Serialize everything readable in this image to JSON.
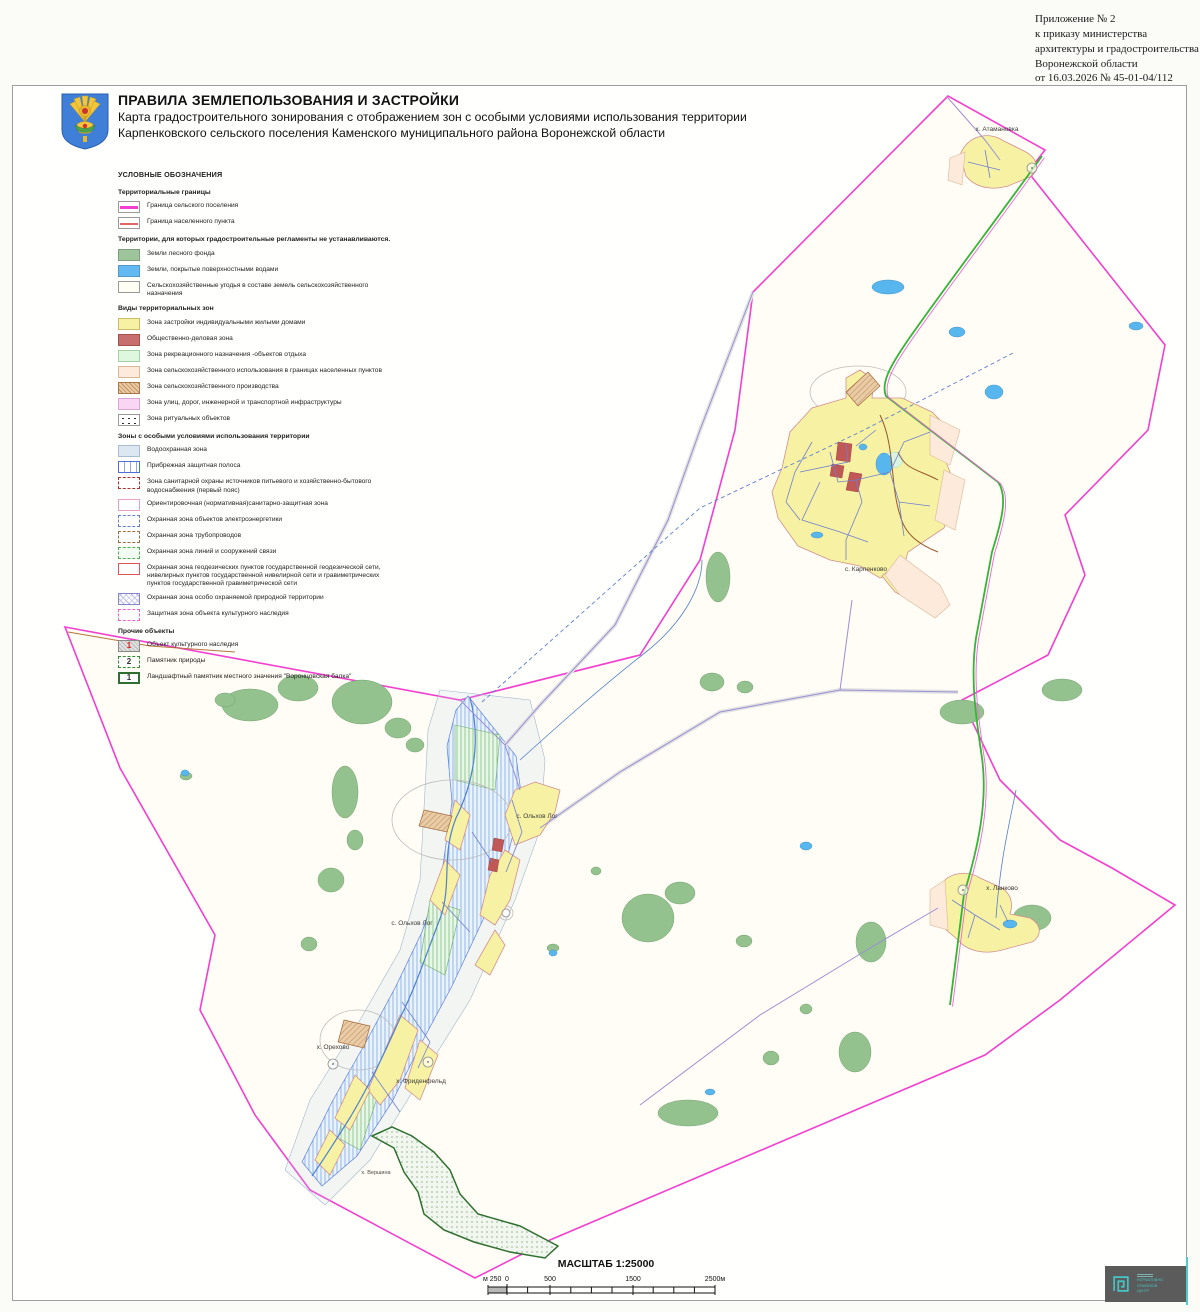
{
  "annotation": {
    "lines": [
      "Приложение № 2",
      "к приказу министерства",
      "архитектуры и градостроительства",
      "Воронежской области",
      "от 16.03.2026 № 45-01-04/112"
    ]
  },
  "header": {
    "title": "ПРАВИЛА ЗЕМЛЕПОЛЬЗОВАНИЯ И ЗАСТРОЙКИ",
    "subtitle_line1": "Карта градостроительного зонирования с отображением зон с особыми условиями использования территории",
    "subtitle_line2": "Карпенковского сельского поселения Каменского муниципального района Воронежской области"
  },
  "legend": {
    "heading": "УСЛОВНЫЕ ОБОЗНАЧЕНИЯ",
    "sections": [
      {
        "title": "Территориальные границы",
        "items": [
          {
            "swatch": "sw-line-magenta",
            "label": "Граница сельского поселения"
          },
          {
            "swatch": "sw-line-red",
            "label": "Граница населенного пункта"
          }
        ]
      },
      {
        "title": "Территории, для которых градостроительные регламенты не устанавливаются.",
        "items": [
          {
            "swatch": "sw-forest",
            "label": "Земли лесного фонда"
          },
          {
            "swatch": "sw-water",
            "label": "Земли, покрытые поверхностными водами"
          },
          {
            "swatch": "sw-agro",
            "label": "Сельскохозяйственные угодья в составе земель сельскохозяйственного назначения"
          }
        ]
      },
      {
        "title": "Виды территориальных зон",
        "items": [
          {
            "swatch": "sw-res",
            "label": "Зона застройки индивидуальными жилыми домами"
          },
          {
            "swatch": "sw-biz",
            "label": "Общественно-деловая зона"
          },
          {
            "swatch": "sw-rec",
            "label": "Зона рекреационного назначения -объектов отдыха"
          },
          {
            "swatch": "sw-agro-set",
            "label": "Зона сельскохозяйственного использования в границах населенных пунктов"
          },
          {
            "swatch": "sw-agro-prod",
            "label": "Зона сельскохозяйственного производства"
          },
          {
            "swatch": "sw-transport",
            "label": "Зона улиц, дорог, инженерной и транспортной инфраструктуры"
          },
          {
            "swatch": "sw-ritual",
            "label": "Зона ритуальных объектов"
          }
        ]
      },
      {
        "title": "Зоны с особыми условиями использования территории",
        "items": [
          {
            "swatch": "sw-wpz",
            "label": "Водоохранная зона"
          },
          {
            "swatch": "sw-shore",
            "label": "Прибрежная защитная полоса"
          },
          {
            "swatch": "sw-zso1",
            "label": "Зона санитарной охраны источников питьевого и хозяйственно-бытового водоснабжения (первый пояс)"
          },
          {
            "swatch": "sw-szz",
            "label": "Ориентировочная (нормативная)санитарно-защитная зона"
          },
          {
            "swatch": "sw-power",
            "label": "Охранная зона объектов электроэнергетики"
          },
          {
            "swatch": "sw-pipe",
            "label": "Охранная зона трубопроводов"
          },
          {
            "swatch": "sw-comm",
            "label": "Охранная зона линий и сооружений связи"
          },
          {
            "swatch": "sw-geo",
            "label": "Охранная зона геодезических пунктов государственной геодезической сети, нивелирных пунктов государственной нивелирной сети и гравиметрических пунктов государственной гравиметрической сети"
          },
          {
            "swatch": "sw-oopt",
            "label": "Охранная зона особо охраняемой природной территории"
          },
          {
            "swatch": "sw-okn-protect",
            "label": "Защитная зона объекта культурного наследия"
          }
        ]
      },
      {
        "title": "Прочие объекты",
        "items": [
          {
            "swatch": "sw-okn",
            "badge": "1",
            "label": "Объект культурного наследия"
          },
          {
            "swatch": "sw-nature",
            "badge": "2",
            "label": "Памятник природы"
          },
          {
            "swatch": "sw-landscape",
            "badge": "1",
            "label": "Ландшафтный памятник местного значения \"Воронцовская балка\""
          }
        ]
      }
    ]
  },
  "map": {
    "labels": [
      {
        "text": "х. Атамановка"
      },
      {
        "text": "с. Карпенково"
      },
      {
        "text": "с. Ольхов Лог"
      },
      {
        "text": "с. Ольхов Лог"
      },
      {
        "text": "х. Орехово"
      },
      {
        "text": "х. Фриденфельд"
      },
      {
        "text": "х. Ланково"
      },
      {
        "text": "х. Вершина"
      }
    ]
  },
  "scale": {
    "title": "МАСШТАБ 1:25000",
    "ticks": [
      "м 250",
      "0",
      "500",
      "1500",
      "2500м"
    ]
  },
  "stamp": {
    "lines": [
      "НОРМАТИВНО-",
      "ПРАВОВОЙ",
      "ЦЕНТР"
    ]
  },
  "palette": {
    "settlement_boundary": "#f23fd0",
    "locality_boundary": "#e06666",
    "forest": "#94c28e",
    "water": "#58b6ef",
    "residential": "#f7f2a3",
    "business": "#c05858",
    "recreation": "#dff7df",
    "agro_in_settlement": "#fdeada",
    "agro_production": "#d8ae82",
    "transport": "#f8d6f4",
    "road_green": "#35b535",
    "stamp_teal": "#45c8c8"
  }
}
